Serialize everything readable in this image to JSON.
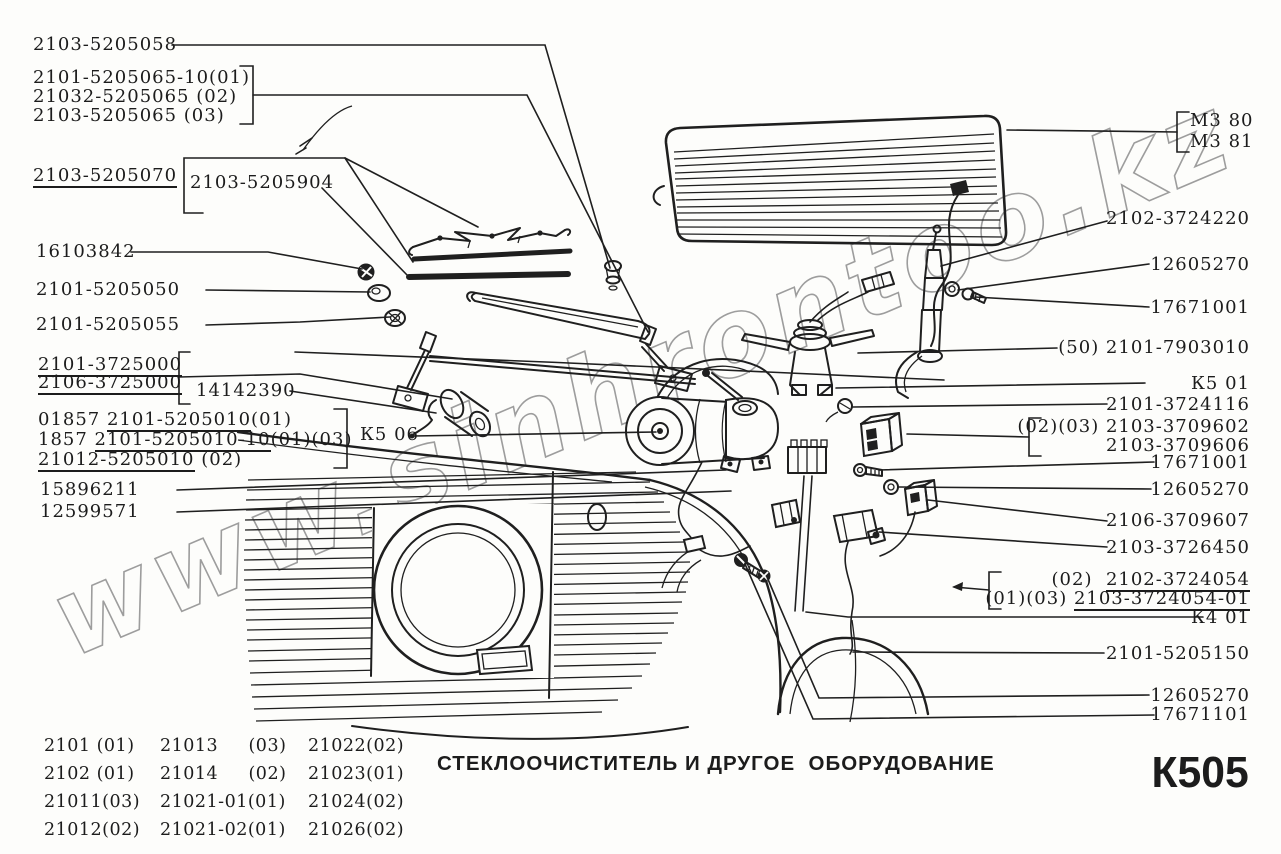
{
  "watermark": "www.sinhrontoo.kz",
  "title": "СТЕКЛООЧИСТИТЕЛЬ И ДРУГОЕ  ОБОРУДОВАНИЕ",
  "page_code": "К505",
  "ink_color": "#1f1f1f",
  "watermark_color": "#9d9d9d",
  "left_labels": {
    "a1": "2103-5205058",
    "a2": "2101-5205065-10(01)",
    "a3": "21032-5205065 (02)",
    "a4": "2103-5205065 (03)",
    "a5": "2103-5205070",
    "a6": "2103-5205904",
    "a7": "16103842",
    "a8": "2101-5205050",
    "a9": "2101-5205055",
    "a10": "2101-3725000",
    "a11": "2106-3725000",
    "a12": "14142390",
    "a13_pre": "01857 ",
    "a13_u": "2101-5205010",
    "a13_suf": "(01)",
    "a14_pre": "1857 ",
    "a14_u": "2101-5205010-10",
    "a14_suf": "(01)(03)",
    "a15_u": "21012-5205010",
    "a15_suf": " (02)",
    "a16": "К5 06",
    "a17": "15896211",
    "a18": "12599571"
  },
  "right_labels": {
    "b1": "М3 80",
    "b2": "М3 81",
    "b3": "2102-3724220",
    "b4": "12605270",
    "b5": "17671001",
    "b6": "(50) 2101-7903010",
    "b7": "К5 01",
    "b8": "2101-3724116",
    "b9_pre": "(02)(03) ",
    "b9": "2103-3709602",
    "b10": "2103-3709606",
    "b11": "17671001",
    "b12": "12605270",
    "b13": "2106-3709607",
    "b14": "2103-3726450",
    "b15_pre": "(02)  ",
    "b15_u": "2102-3724054",
    "b16_pre": "(01)(03) ",
    "b16_u": "2103-3724054-01",
    "b17": "К4 01",
    "b18": "2101-5205150",
    "b19": "12605270",
    "b20": "17671101"
  },
  "variant_table": {
    "rows": [
      [
        "2101 (01)",
        "21013     (03)",
        "21022(02)"
      ],
      [
        "2102 (01)",
        "21014     (02)",
        "21023(01)"
      ],
      [
        "21011(03)",
        "21021-01(01)",
        "21024(02)"
      ],
      [
        "21012(02)",
        "21021-02(01)",
        "21026(02)"
      ]
    ]
  }
}
